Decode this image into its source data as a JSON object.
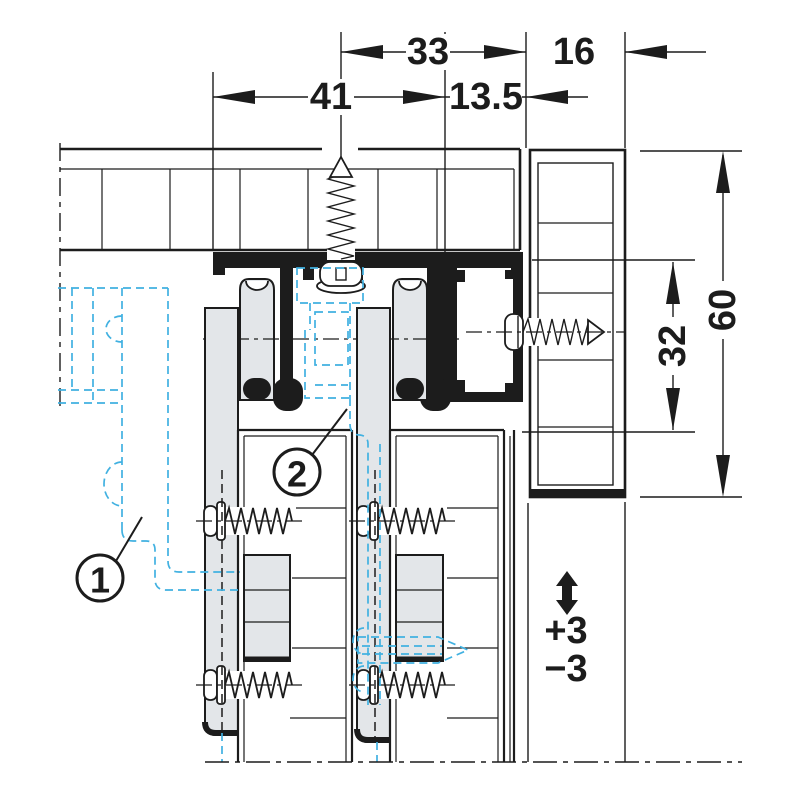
{
  "drawing": {
    "dimensions": {
      "width_41": "41",
      "width_33": "33",
      "width_13_5": "13.5",
      "width_16": "16",
      "height_60": "60",
      "height_32": "32"
    },
    "adjustment": {
      "plus": "+3",
      "minus": "−3"
    },
    "callouts": {
      "part1": "1",
      "part2": "2"
    },
    "colors": {
      "line": "#1c1c1c",
      "hardware_fill": "#e3e6e9",
      "phantom_blue": "#41b1e1",
      "background": "#ffffff"
    }
  }
}
